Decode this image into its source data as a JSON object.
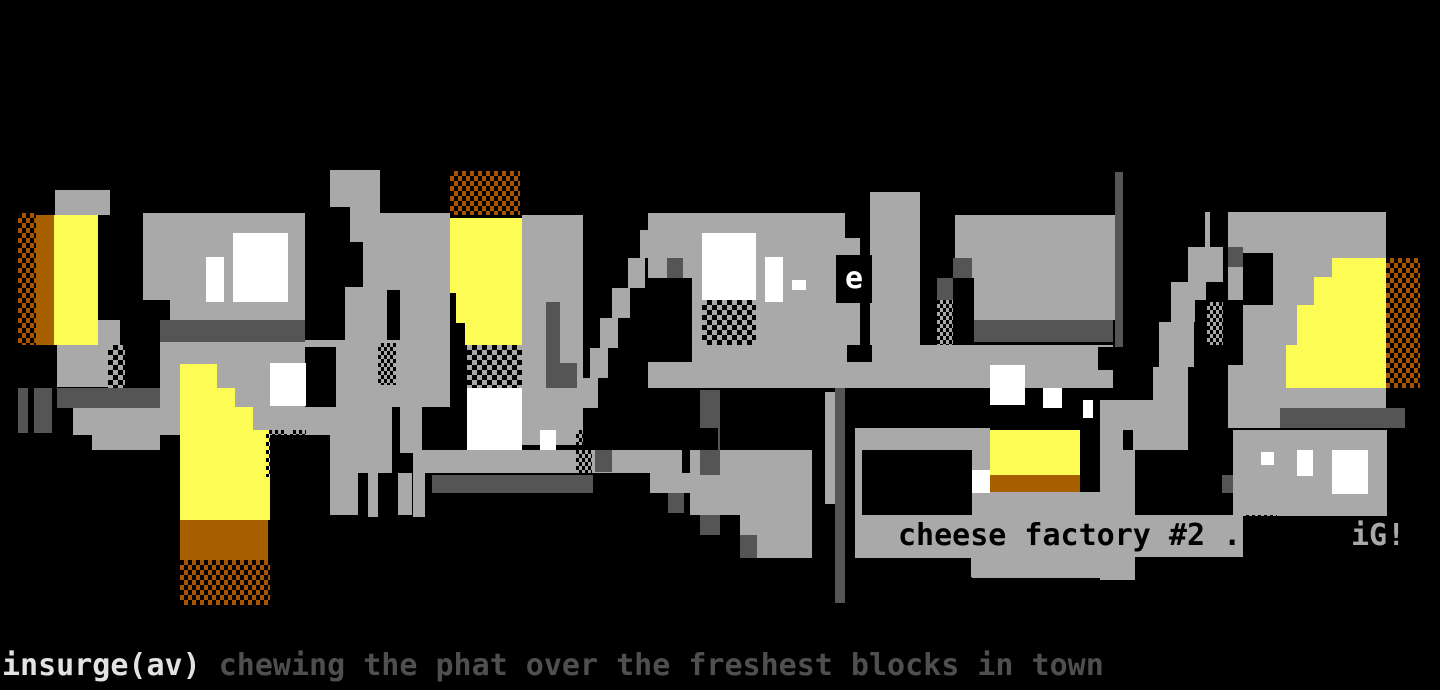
{
  "artwork": {
    "title_word": "insurge",
    "canvas": {
      "width": 1440,
      "height": 690,
      "background": "#000000"
    },
    "palette": {
      "gray": "#a9a9a9",
      "dark_gray": "#555555",
      "yellow": "#fcfc54",
      "orange": "#a85f00",
      "white": "#ffffff",
      "black": "#000000"
    },
    "rect_format": [
      "x",
      "y",
      "w",
      "h",
      "pattern"
    ],
    "rects": [
      [
        55,
        190,
        55,
        25,
        "g"
      ],
      [
        98,
        320,
        22,
        25,
        "g"
      ],
      [
        57,
        345,
        51,
        42,
        "g"
      ],
      [
        73,
        408,
        87,
        27,
        "g"
      ],
      [
        92,
        435,
        68,
        15,
        "g"
      ],
      [
        143,
        213,
        162,
        107,
        "g"
      ],
      [
        160,
        340,
        185,
        95,
        "g"
      ],
      [
        336,
        340,
        84,
        67,
        "g"
      ],
      [
        330,
        170,
        50,
        37,
        "g"
      ],
      [
        350,
        207,
        30,
        35,
        "g"
      ],
      [
        363,
        242,
        37,
        48,
        "g"
      ],
      [
        345,
        287,
        42,
        58,
        "g"
      ],
      [
        335,
        342,
        52,
        67,
        "g"
      ],
      [
        330,
        407,
        62,
        66,
        "g"
      ],
      [
        330,
        473,
        28,
        42,
        "g"
      ],
      [
        368,
        473,
        10,
        44,
        "g"
      ],
      [
        398,
        473,
        14,
        42,
        "g"
      ],
      [
        413,
        440,
        12,
        77,
        "g"
      ],
      [
        380,
        213,
        70,
        60,
        "g"
      ],
      [
        400,
        273,
        50,
        180,
        "g"
      ],
      [
        425,
        450,
        257,
        23,
        "g"
      ],
      [
        522,
        215,
        61,
        230,
        "g"
      ],
      [
        648,
        213,
        212,
        175,
        "g"
      ],
      [
        640,
        230,
        13,
        28,
        "g"
      ],
      [
        628,
        258,
        17,
        30,
        "g"
      ],
      [
        612,
        288,
        18,
        30,
        "g"
      ],
      [
        600,
        318,
        18,
        30,
        "g"
      ],
      [
        590,
        348,
        18,
        30,
        "g"
      ],
      [
        580,
        378,
        18,
        30,
        "g"
      ],
      [
        825,
        392,
        10,
        112,
        "g"
      ],
      [
        690,
        450,
        122,
        65,
        "g"
      ],
      [
        740,
        515,
        72,
        43,
        "g"
      ],
      [
        650,
        473,
        40,
        20,
        "g"
      ],
      [
        870,
        192,
        50,
        153,
        "g"
      ],
      [
        955,
        215,
        162,
        105,
        "g"
      ],
      [
        860,
        345,
        253,
        43,
        "g"
      ],
      [
        855,
        428,
        135,
        130,
        "g"
      ],
      [
        972,
        558,
        161,
        20,
        "g"
      ],
      [
        1205,
        212,
        18,
        35,
        "g"
      ],
      [
        1188,
        247,
        35,
        35,
        "g"
      ],
      [
        1171,
        282,
        35,
        40,
        "g"
      ],
      [
        1159,
        322,
        35,
        45,
        "g"
      ],
      [
        1153,
        367,
        35,
        45,
        "g"
      ],
      [
        1147,
        412,
        41,
        38,
        "g"
      ],
      [
        1228,
        212,
        158,
        216,
        "g"
      ],
      [
        1100,
        400,
        88,
        50,
        "g"
      ],
      [
        1100,
        450,
        35,
        130,
        "g"
      ],
      [
        1233,
        430,
        154,
        86,
        "g"
      ],
      [
        865,
        515,
        378,
        42,
        "g"
      ],
      [
        971,
        492,
        164,
        85,
        "g"
      ],
      [
        57,
        388,
        103,
        20,
        "d"
      ],
      [
        18,
        388,
        10,
        45,
        "d"
      ],
      [
        34,
        388,
        18,
        45,
        "d"
      ],
      [
        160,
        320,
        145,
        22,
        "d"
      ],
      [
        432,
        475,
        161,
        18,
        "d"
      ],
      [
        546,
        302,
        14,
        86,
        "d"
      ],
      [
        558,
        363,
        19,
        25,
        "d"
      ],
      [
        595,
        450,
        17,
        22,
        "d"
      ],
      [
        835,
        388,
        10,
        215,
        "d"
      ],
      [
        1115,
        172,
        8,
        185,
        "d"
      ],
      [
        973,
        320,
        140,
        22,
        "d"
      ],
      [
        700,
        390,
        20,
        85,
        "d"
      ],
      [
        630,
        473,
        20,
        18,
        "d"
      ],
      [
        668,
        493,
        16,
        20,
        "d"
      ],
      [
        700,
        515,
        20,
        20,
        "d"
      ],
      [
        740,
        535,
        17,
        23,
        "d"
      ],
      [
        1280,
        408,
        125,
        20,
        "d"
      ],
      [
        937,
        278,
        16,
        22,
        "d"
      ],
      [
        953,
        258,
        19,
        20,
        "d"
      ],
      [
        667,
        258,
        16,
        20,
        "d"
      ],
      [
        1222,
        475,
        11,
        18,
        "d"
      ],
      [
        1228,
        247,
        15,
        20,
        "d"
      ],
      [
        143,
        300,
        27,
        20,
        "k"
      ],
      [
        305,
        347,
        31,
        60,
        "k"
      ],
      [
        422,
        407,
        28,
        43,
        "k"
      ],
      [
        648,
        278,
        44,
        84,
        "k"
      ],
      [
        845,
        213,
        17,
        25,
        "k"
      ],
      [
        847,
        345,
        25,
        17,
        "k"
      ],
      [
        862,
        450,
        110,
        65,
        "k"
      ],
      [
        955,
        278,
        19,
        67,
        "k"
      ],
      [
        1195,
        300,
        48,
        65,
        "k"
      ],
      [
        1188,
        403,
        37,
        47,
        "k"
      ],
      [
        1123,
        430,
        10,
        20,
        "k"
      ],
      [
        1135,
        450,
        53,
        25,
        "k"
      ],
      [
        1210,
        212,
        18,
        35,
        "k"
      ],
      [
        1243,
        253,
        30,
        52,
        "k"
      ],
      [
        1098,
        347,
        25,
        23,
        "k"
      ],
      [
        630,
        407,
        45,
        21,
        "k"
      ],
      [
        652,
        428,
        66,
        22,
        "k"
      ],
      [
        612,
        473,
        38,
        20,
        "k"
      ],
      [
        855,
        393,
        133,
        35,
        "ka"
      ],
      [
        54,
        215,
        44,
        130,
        "y"
      ],
      [
        180,
        364,
        37,
        24,
        "y"
      ],
      [
        180,
        388,
        55,
        19,
        "y"
      ],
      [
        180,
        407,
        73,
        23,
        "y"
      ],
      [
        180,
        430,
        90,
        90,
        "y"
      ],
      [
        450,
        218,
        72,
        75,
        "y"
      ],
      [
        456,
        293,
        66,
        30,
        "y"
      ],
      [
        465,
        323,
        57,
        22,
        "y"
      ],
      [
        990,
        430,
        90,
        45,
        "y"
      ],
      [
        1332,
        258,
        54,
        130,
        "y"
      ],
      [
        1314,
        277,
        72,
        111,
        "y"
      ],
      [
        1297,
        305,
        89,
        83,
        "y"
      ],
      [
        1286,
        345,
        100,
        43,
        "y"
      ],
      [
        36,
        215,
        18,
        130,
        "o"
      ],
      [
        180,
        520,
        88,
        40,
        "o"
      ],
      [
        990,
        475,
        90,
        17,
        "o"
      ],
      [
        233,
        233,
        55,
        69,
        "w"
      ],
      [
        206,
        257,
        18,
        45,
        "w"
      ],
      [
        270,
        363,
        36,
        43,
        "w"
      ],
      [
        467,
        388,
        55,
        62,
        "w"
      ],
      [
        540,
        430,
        16,
        20,
        "w"
      ],
      [
        702,
        233,
        54,
        67,
        "w"
      ],
      [
        765,
        257,
        18,
        45,
        "w"
      ],
      [
        792,
        280,
        14,
        10,
        "w"
      ],
      [
        990,
        365,
        35,
        40,
        "w"
      ],
      [
        1043,
        388,
        19,
        20,
        "w"
      ],
      [
        1083,
        400,
        10,
        18,
        "w"
      ],
      [
        972,
        470,
        18,
        23,
        "w"
      ],
      [
        1261,
        452,
        13,
        13,
        "w"
      ],
      [
        1297,
        450,
        16,
        26,
        "w"
      ],
      [
        1332,
        450,
        36,
        44,
        "w"
      ],
      [
        18,
        213,
        18,
        132,
        "och"
      ],
      [
        180,
        560,
        90,
        45,
        "och"
      ],
      [
        450,
        171,
        70,
        44,
        "och"
      ],
      [
        1386,
        258,
        34,
        130,
        "och"
      ],
      [
        108,
        345,
        17,
        43,
        "chk"
      ],
      [
        467,
        345,
        55,
        43,
        "chk"
      ],
      [
        702,
        300,
        54,
        45,
        "chk"
      ],
      [
        128,
        320,
        14,
        25,
        "bdg"
      ],
      [
        266,
        430,
        21,
        47,
        "bdg"
      ],
      [
        290,
        430,
        16,
        47,
        "bdg"
      ],
      [
        378,
        343,
        18,
        42,
        "bdg"
      ],
      [
        576,
        430,
        16,
        45,
        "bdg"
      ],
      [
        648,
        303,
        17,
        42,
        "bdg"
      ],
      [
        1243,
        515,
        34,
        44,
        "bdg"
      ],
      [
        937,
        300,
        16,
        45,
        "gdb"
      ],
      [
        1207,
        302,
        16,
        43,
        "gdb"
      ]
    ]
  },
  "labels": {
    "e_glyph": "e",
    "cheese_caption": "cheese factory #2 .",
    "group_sig": "iG!",
    "credit_name": "insurge(av)",
    "credit_tagline": " chewing the phat over the freshest blocks in town"
  }
}
